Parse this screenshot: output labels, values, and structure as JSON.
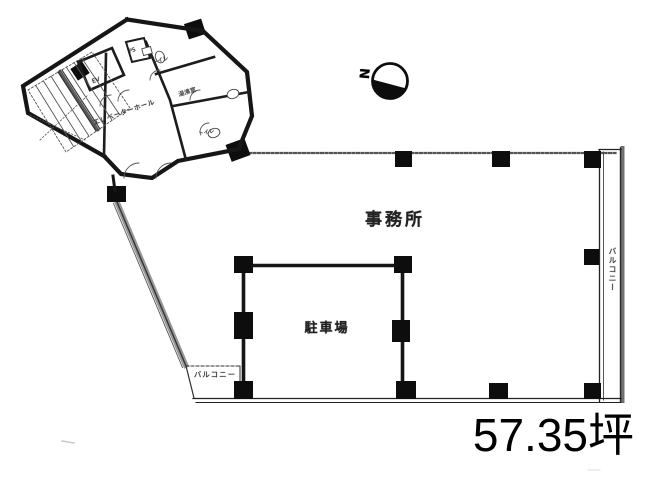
{
  "plan": {
    "labels": {
      "office": "事務所",
      "parking": "駐車場",
      "balcony_right": "バルコニー",
      "balcony_left": "バルコニー",
      "elevator_hall": "エレベーターホール",
      "elevator": "EV",
      "pipe_shaft": "PS",
      "kitchenette": "湯沸室",
      "toilet_upper": "トイレ",
      "toilet_lower": "トイレ"
    },
    "compass": {
      "north": "N"
    },
    "area": {
      "value": "57.35坪"
    },
    "colors": {
      "ink": "#1a1a1a",
      "paper": "#ffffff"
    }
  }
}
